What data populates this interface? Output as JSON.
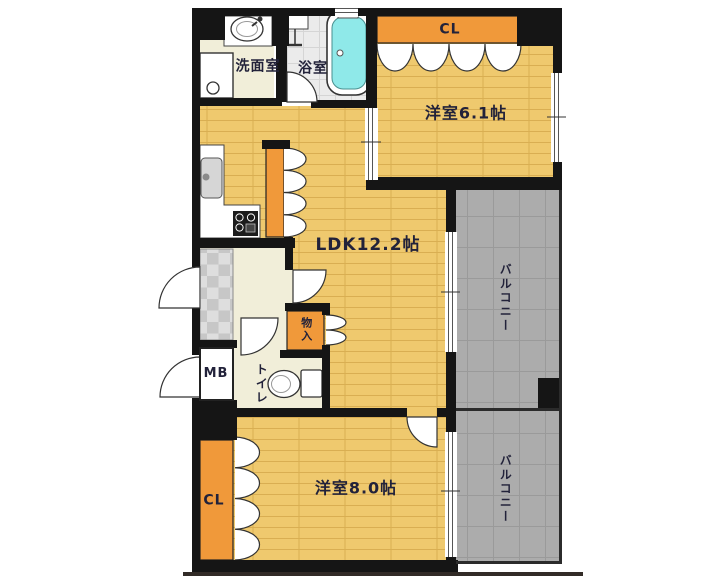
{
  "floorplan": {
    "rooms": {
      "washroom": {
        "label": "洗面室"
      },
      "bathroom": {
        "label": "浴室"
      },
      "closet_top": {
        "label": "CL"
      },
      "bedroom1": {
        "label": "洋室6.1帖"
      },
      "ldk": {
        "label": "LDK12.2帖"
      },
      "balcony_upper": {
        "label": "バルコニー"
      },
      "balcony_lower": {
        "label": "バルコニー"
      },
      "storage": {
        "label": "物入"
      },
      "meter_box": {
        "label": "MB"
      },
      "toilet": {
        "label": "トイレ"
      },
      "closet_bottom": {
        "label": "CL"
      },
      "bedroom2": {
        "label": "洋室8.0帖"
      }
    },
    "colors": {
      "wall": "#151515",
      "wood_floor": "#efc96e",
      "wood_line": "#d9ae52",
      "cream_floor": "#f1eed9",
      "bathroom_floor": "#ebebeb",
      "bath_tile_line": "#d5d5d5",
      "balcony_floor": "#acacac",
      "balcony_line": "#9a9a9a",
      "tile_light": "#dedede",
      "tile_dark": "#c7c7c7",
      "closet_orange": "#f0993a",
      "bathtub_fill": "#8fe9e9",
      "label_color": "#22223a"
    }
  }
}
